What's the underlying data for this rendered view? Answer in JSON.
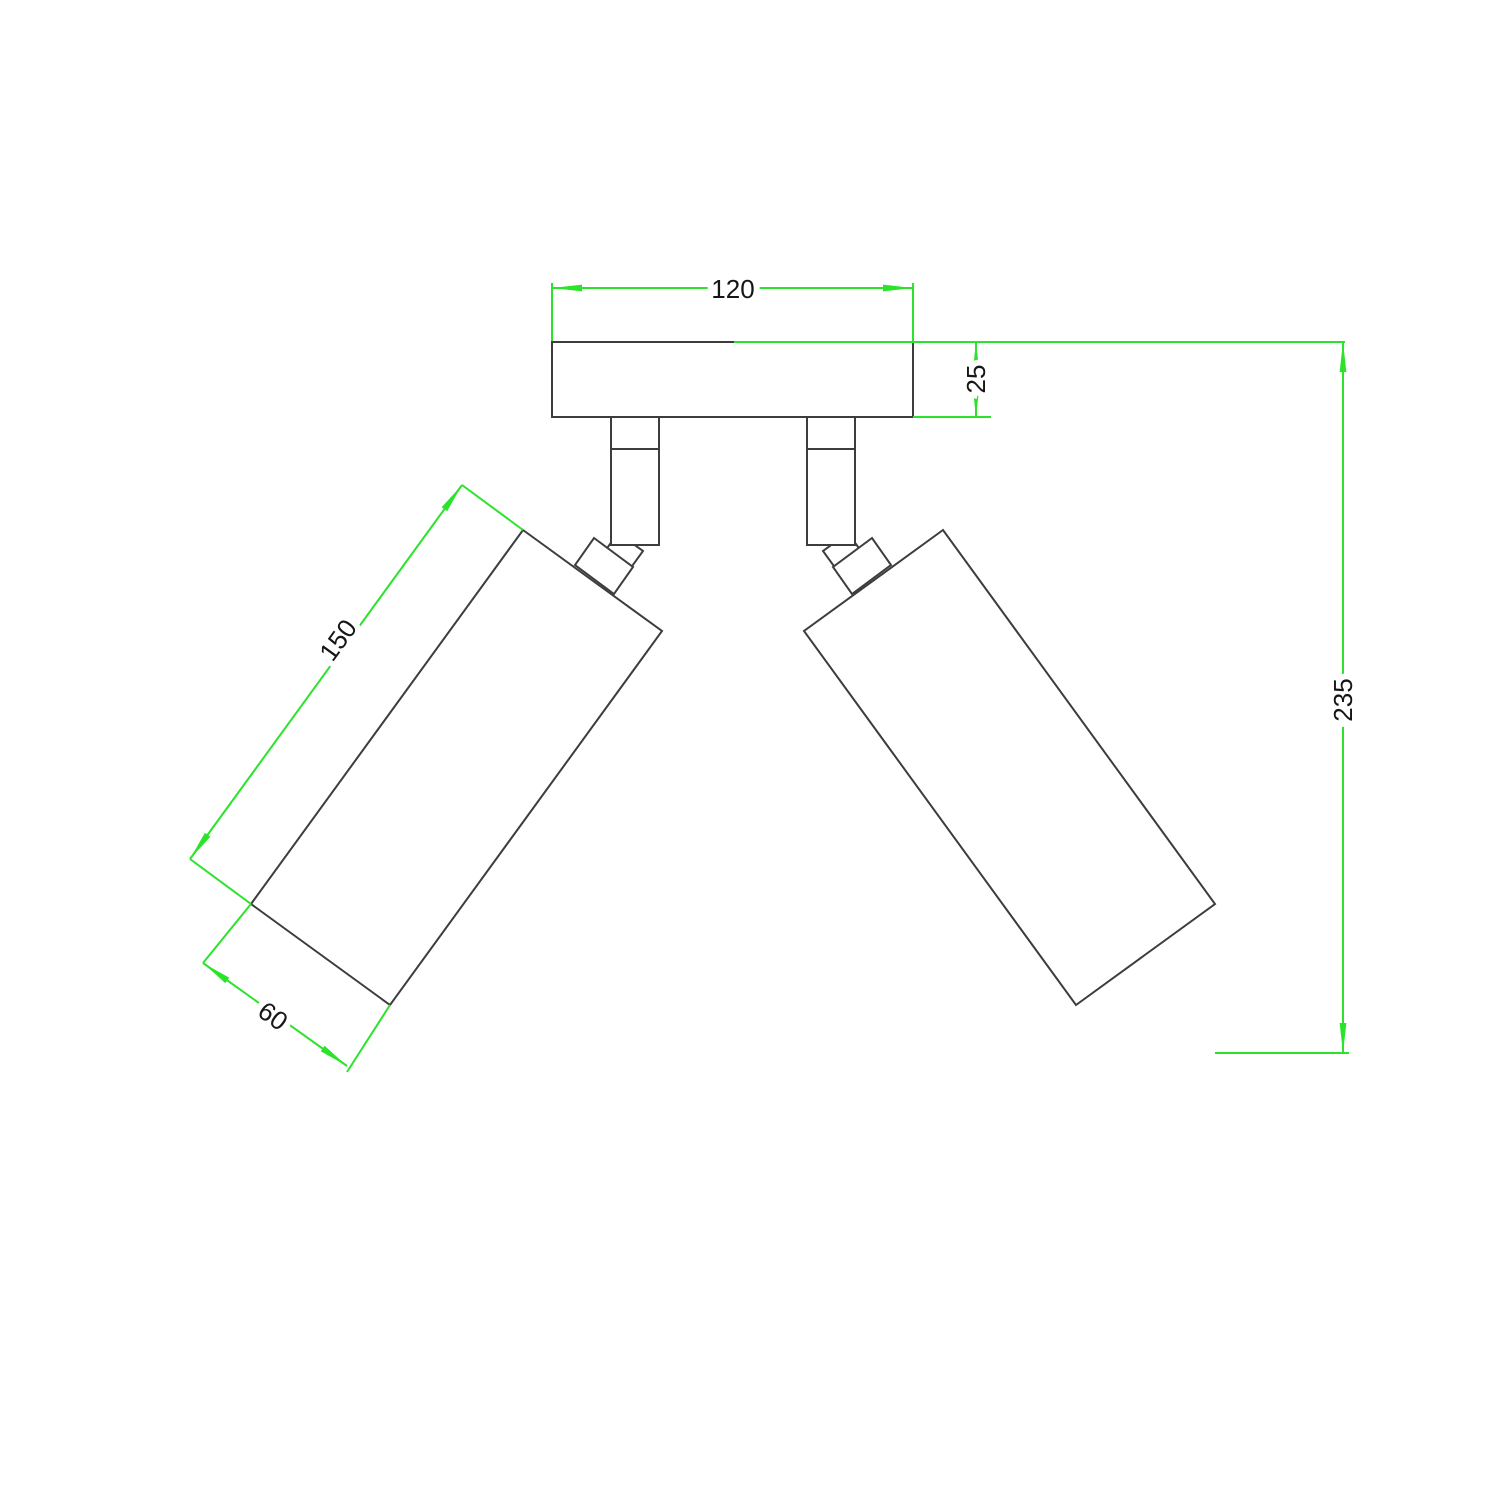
{
  "drawing": {
    "dimensions": {
      "plate_width": "120",
      "plate_thickness": "25",
      "shade_length": "150",
      "shade_diameter": "60",
      "total_height": "235"
    },
    "colors": {
      "dimension_green": "#2ce32c",
      "outline_gray": "#3d3d3d",
      "label_dark": "#161616",
      "background": "#ffffff"
    }
  }
}
